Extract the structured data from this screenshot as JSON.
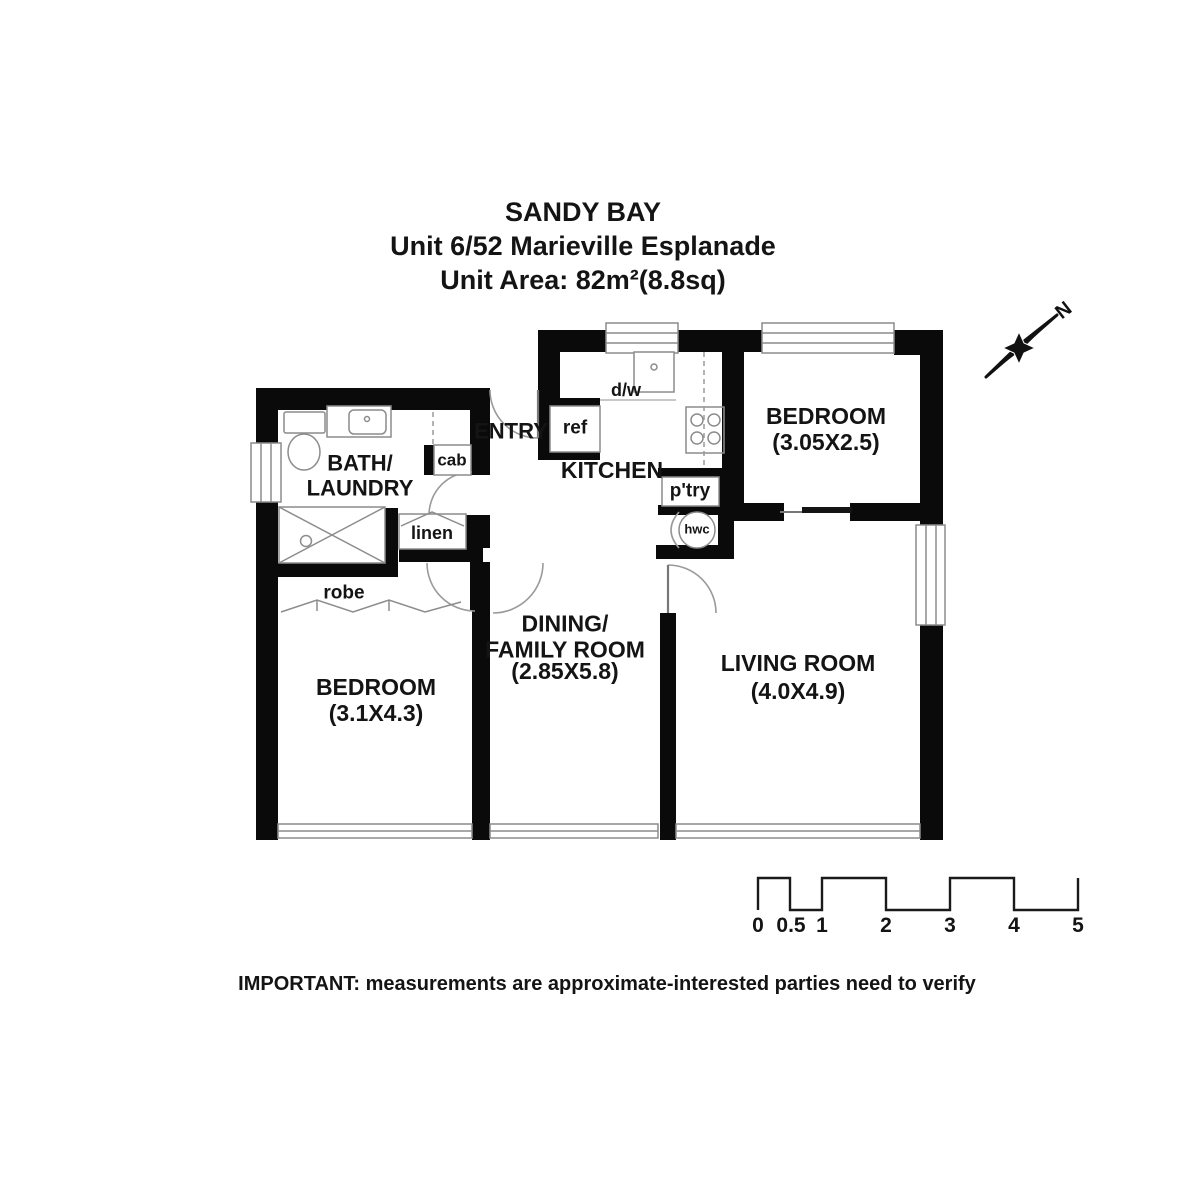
{
  "title": {
    "line1": "SANDY BAY",
    "line2": "Unit 6/52 Marieville Esplanade",
    "line3": "Unit Area: 82m²(8.8sq)"
  },
  "plan": {
    "rooms": {
      "bath": {
        "name": "BATH/\nLAUNDRY"
      },
      "entry": {
        "name": "ENTRY"
      },
      "kitchen": {
        "name": "KITCHEN"
      },
      "bedroom1": {
        "name": "BEDROOM",
        "dims": "(3.05X2.5)"
      },
      "dining": {
        "name": "DINING/\nFAMILY ROOM",
        "dims": "(2.85X5.8)"
      },
      "living": {
        "name": "LIVING ROOM",
        "dims": "(4.0X4.9)"
      },
      "bedroom2": {
        "name": "BEDROOM",
        "dims": "(3.1X4.3)"
      }
    },
    "fixtures": {
      "dw": "d/w",
      "ref": "ref",
      "cab": "cab",
      "linen": "linen",
      "robe": "robe",
      "ptry": "p'try",
      "hwc": "hwc"
    }
  },
  "north_label": "N",
  "scale_bar": {
    "labels": [
      "0",
      "0.5",
      "1",
      "2",
      "3",
      "4",
      "5"
    ]
  },
  "disclaimer": "IMPORTANT: measurements are approximate-interested parties need to verify",
  "colors": {
    "wall": "#0a0a0a",
    "thin_line": "#8c8c8c",
    "background": "#ffffff"
  }
}
